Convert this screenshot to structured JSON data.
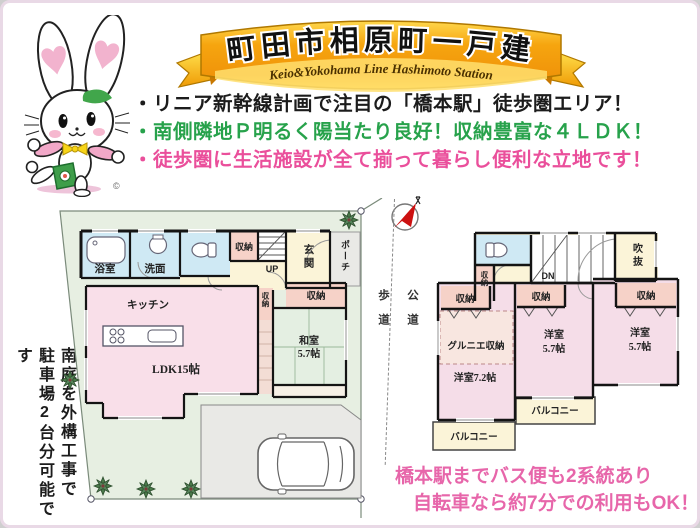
{
  "colors": {
    "ribbon_orange": "#f6a50f",
    "ribbon_yellow": "#ffd84d",
    "bullet_black": "#1c1c1c",
    "bullet_green": "#27a24b",
    "bullet_pink": "#ea4f9b",
    "footer_pink": "#e766aa",
    "plot_green": "#e7efe2",
    "room_pink": "#f9dfe9",
    "room_blue": "#cfe9f4",
    "room_cream": "#fbf4d8",
    "closet_salmon": "#f6d2c8",
    "tatami_green": "#e4efe2",
    "porch_gray": "#e9e9e6",
    "compass_red": "#cc1111"
  },
  "banner": {
    "title": "町田市相原町一戸建",
    "subtitle": "Keio&Yokohama Line Hashimoto Station"
  },
  "mascot": {
    "copyright": "©"
  },
  "bullets": [
    {
      "text": "・リニア新幹線計画で注目の「橋本駅」徒歩圏エリア！"
    },
    {
      "text": "・南側隣地Ｐ明るく陽当たり良好！収納豊富な４ＬＤＫ！"
    },
    {
      "text": "・徒歩圏に生活施設が全て揃って暮らし便利な立地です！"
    }
  ],
  "side_note": {
    "line1": "南庭を外構工事で",
    "line2": "駐車場2台分可能です"
  },
  "floor1": {
    "bath": "浴室",
    "wash": "洗面",
    "storage_a": "収納",
    "up": "UP",
    "entrance": "玄関",
    "porch": "ポーチ",
    "storage_b": "収納",
    "storage_c": "収納",
    "kitchen": "キッチン",
    "ldk": "LDK15帖",
    "washitsu_1": "和室",
    "washitsu_2": "5.7帖"
  },
  "roads": {
    "sidewalk": "歩道",
    "public_road": "公道"
  },
  "floor2": {
    "storage_small": "収納",
    "dn": "DN",
    "void": "吹抜",
    "storage_a": "収納",
    "storage_b": "収納",
    "storage_c": "収納",
    "grenier": "グルニエ収納",
    "room72": "洋室7.2帖",
    "room57a_1": "洋室",
    "room57a_2": "5.7帖",
    "room57b_1": "洋室",
    "room57b_2": "5.7帖",
    "balcony_a": "バルコニー",
    "balcony_b": "バルコニー"
  },
  "footer": {
    "line1": "橋本駅までバス便も2系統あり",
    "line2": "自転車なら約7分での利用もOK！"
  }
}
